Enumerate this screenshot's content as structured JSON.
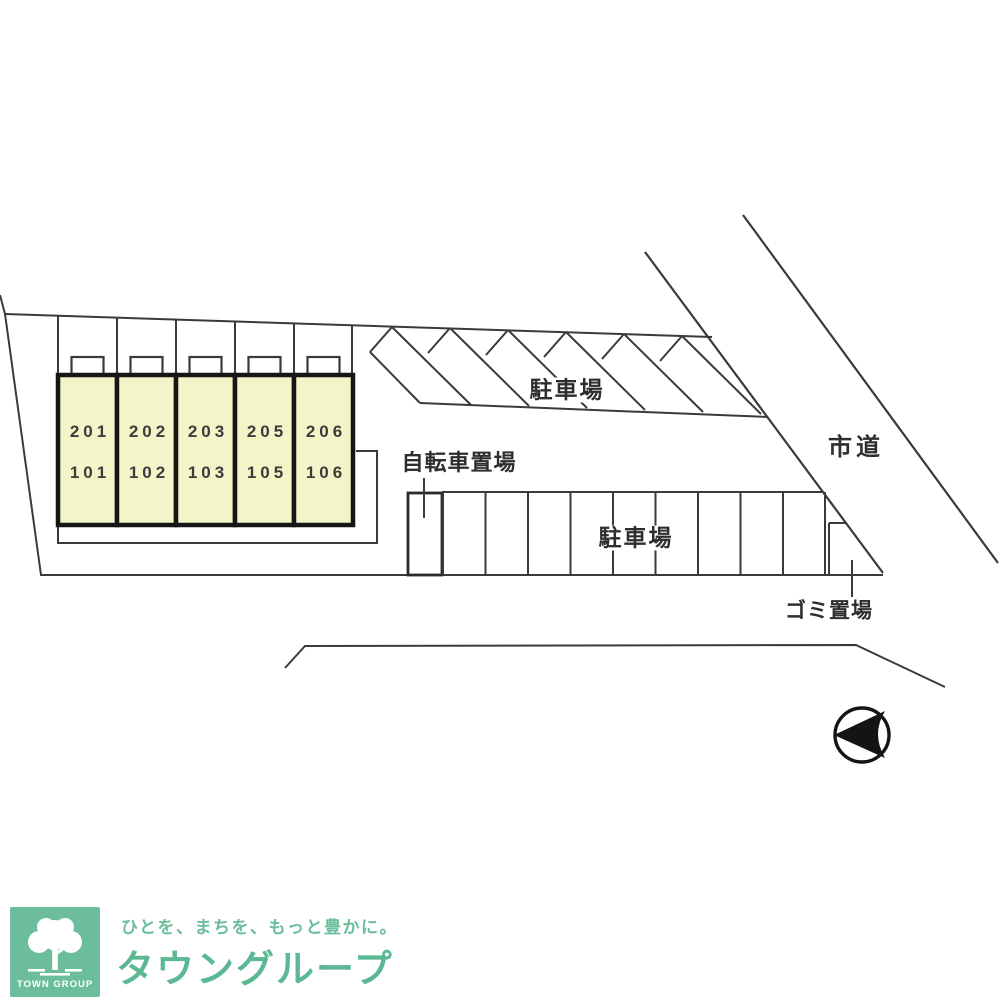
{
  "site_plan": {
    "building": {
      "units": [
        {
          "upper": "201",
          "lower": "101"
        },
        {
          "upper": "202",
          "lower": "102"
        },
        {
          "upper": "203",
          "lower": "103"
        },
        {
          "upper": "205",
          "lower": "105"
        },
        {
          "upper": "206",
          "lower": "106"
        }
      ]
    },
    "labels": {
      "upper_parking": "駐車場",
      "lower_parking": "駐車場",
      "bicycle_parking": "自転車置場",
      "garbage_area": "ゴミ置場",
      "city_road": "市道"
    }
  },
  "branding": {
    "logo_square_text": "TOWN GROUP",
    "tagline": "ひとを、まちを、もっと豊かに。",
    "brand_name": "タウングループ",
    "brand_green": "#6cbd9b"
  },
  "colors": {
    "line": "#3a3a3a",
    "building_fill": "#f4f4c9",
    "building_border": "#161616",
    "background": "#ffffff"
  }
}
